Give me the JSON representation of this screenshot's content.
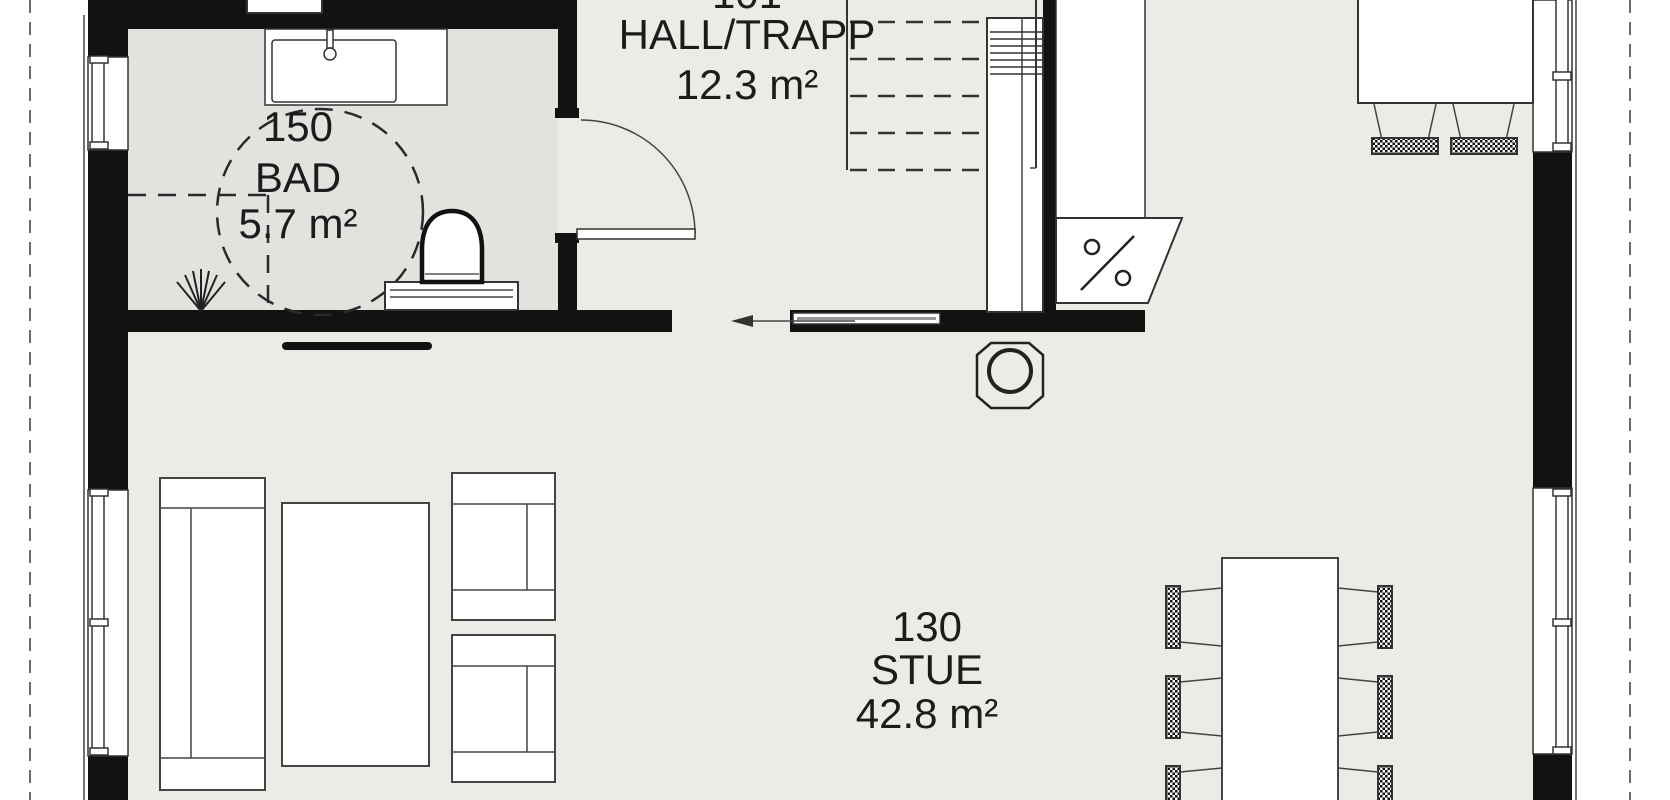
{
  "title": "First floor plan",
  "colors": {
    "wall": "#121212",
    "floor": "#ECECE7",
    "bathroom_floor": "#E2E2DF",
    "line": "#333333",
    "background": "#FFFFFF"
  },
  "rooms": {
    "bad": {
      "number": "150",
      "name": "BAD",
      "area": "5.7 m²"
    },
    "hall": {
      "number": "101",
      "name": "HALL/TRAPP",
      "area": "12.3 m²"
    },
    "stue": {
      "number": "130",
      "name": "STUE",
      "area": "42.8 m²"
    }
  },
  "symbols": [
    "turning-circle",
    "floor-drain",
    "vanity-sink",
    "toilet",
    "hinged-door",
    "sliding-door-arrow",
    "staircase",
    "dishwasher-percent-symbol",
    "kitchen-counter",
    "kitchen-island",
    "bar-stool",
    "wood-stove",
    "radiator",
    "sofa",
    "coffee-table",
    "armchair",
    "dining-table",
    "dining-chair",
    "window",
    "roof-overhang-line"
  ]
}
